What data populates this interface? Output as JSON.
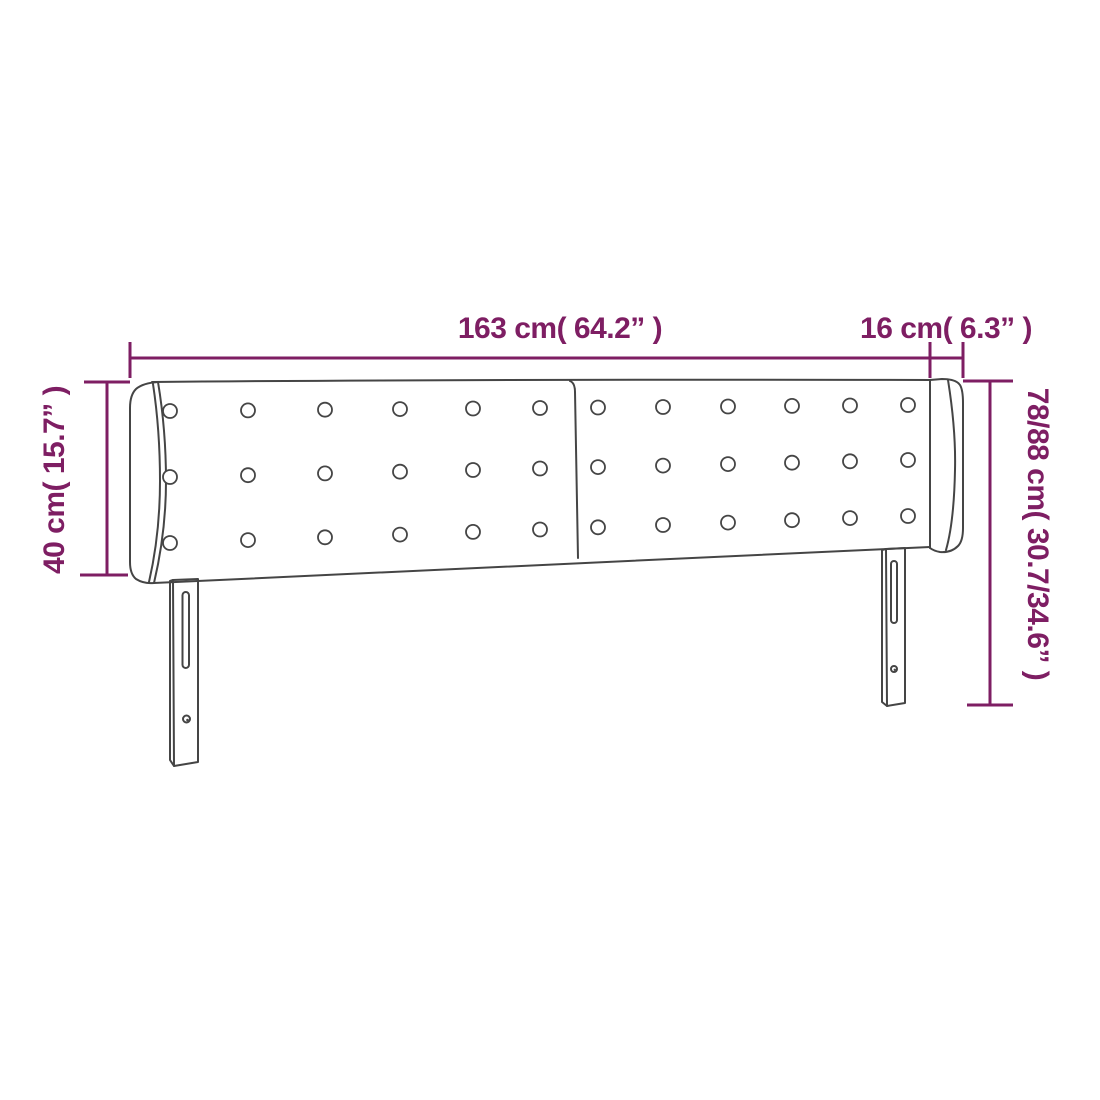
{
  "page": {
    "background": "#ffffff"
  },
  "colors": {
    "accent": "#7E1E63",
    "outline": "#454545"
  },
  "product": {
    "panels": 2,
    "button_rows": 3,
    "button_columns_per_panel": 6
  },
  "dimensions": {
    "width_label": "163 cm( 64.2” )",
    "ear_depth_label": "16 cm( 6.3” )",
    "ear_height_label": "40 cm( 15.7” )",
    "total_height_label": "78/88 cm( 30.7/34.6” )"
  }
}
